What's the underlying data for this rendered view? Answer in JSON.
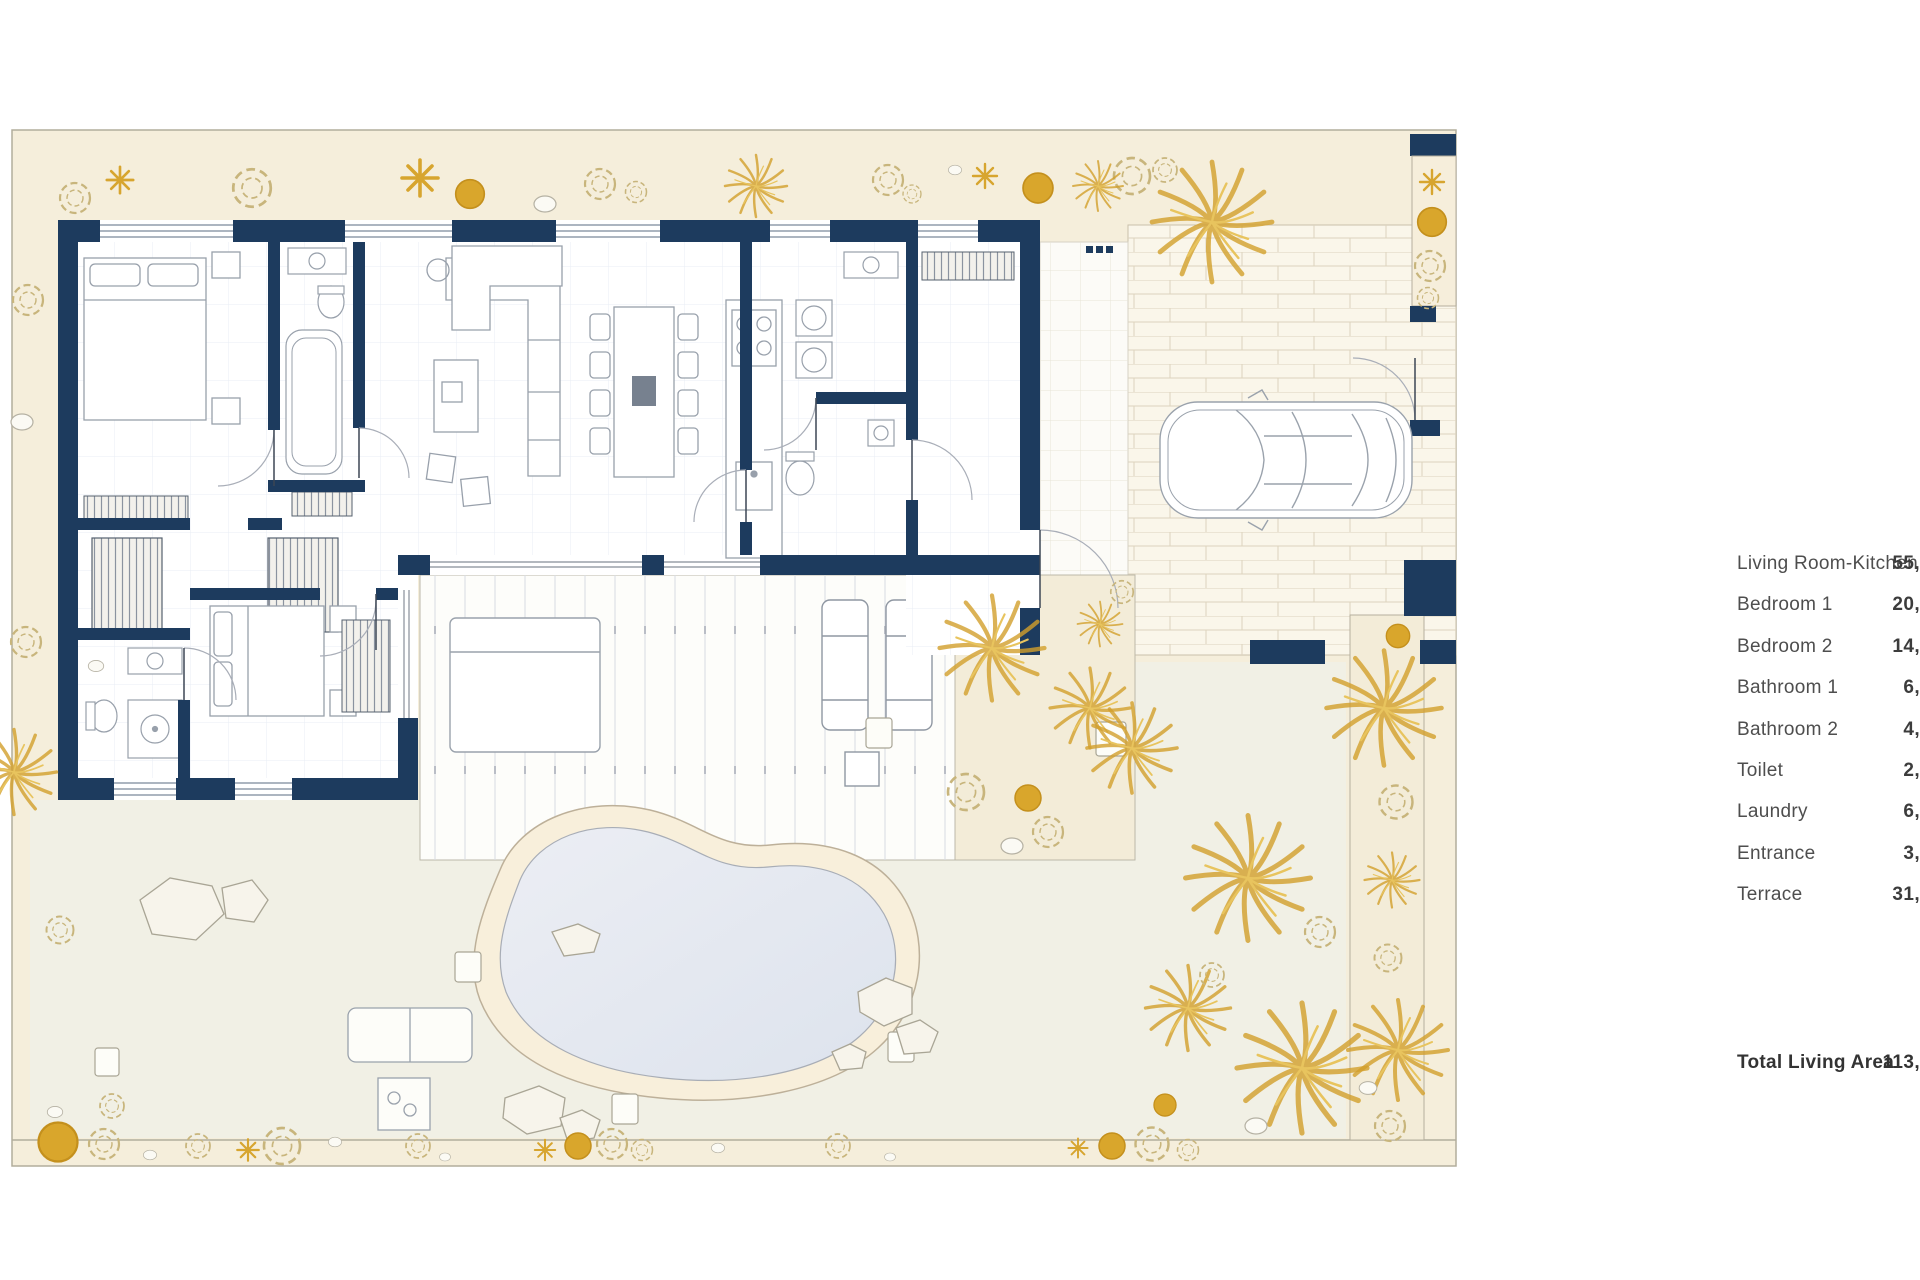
{
  "legend": {
    "items": [
      {
        "label": "Living Room-Kitchen",
        "value": "55,7"
      },
      {
        "label": "Bedroom 1",
        "value": "20,1"
      },
      {
        "label": "Bedroom 2",
        "value": "14,1"
      },
      {
        "label": "Bathroom 1",
        "value": "6,0"
      },
      {
        "label": "Bathroom 2",
        "value": "4,6"
      },
      {
        "label": "Toilet",
        "value": "2,2"
      },
      {
        "label": "Laundry",
        "value": "6,1"
      },
      {
        "label": "Entrance",
        "value": "3,0"
      },
      {
        "label": "Terrace",
        "value": "31,9"
      }
    ],
    "total": {
      "label": "Total Living Area",
      "value": "113,6"
    }
  },
  "colors": {
    "wall_navy": "#1d3b5e",
    "garden_beige": "#f5eedb",
    "garden_south": "#f1f0e5",
    "vegetation_gold": "#d7a52f",
    "pool_water": "#e2e7ef",
    "pool_surround": "#f8efdb"
  }
}
